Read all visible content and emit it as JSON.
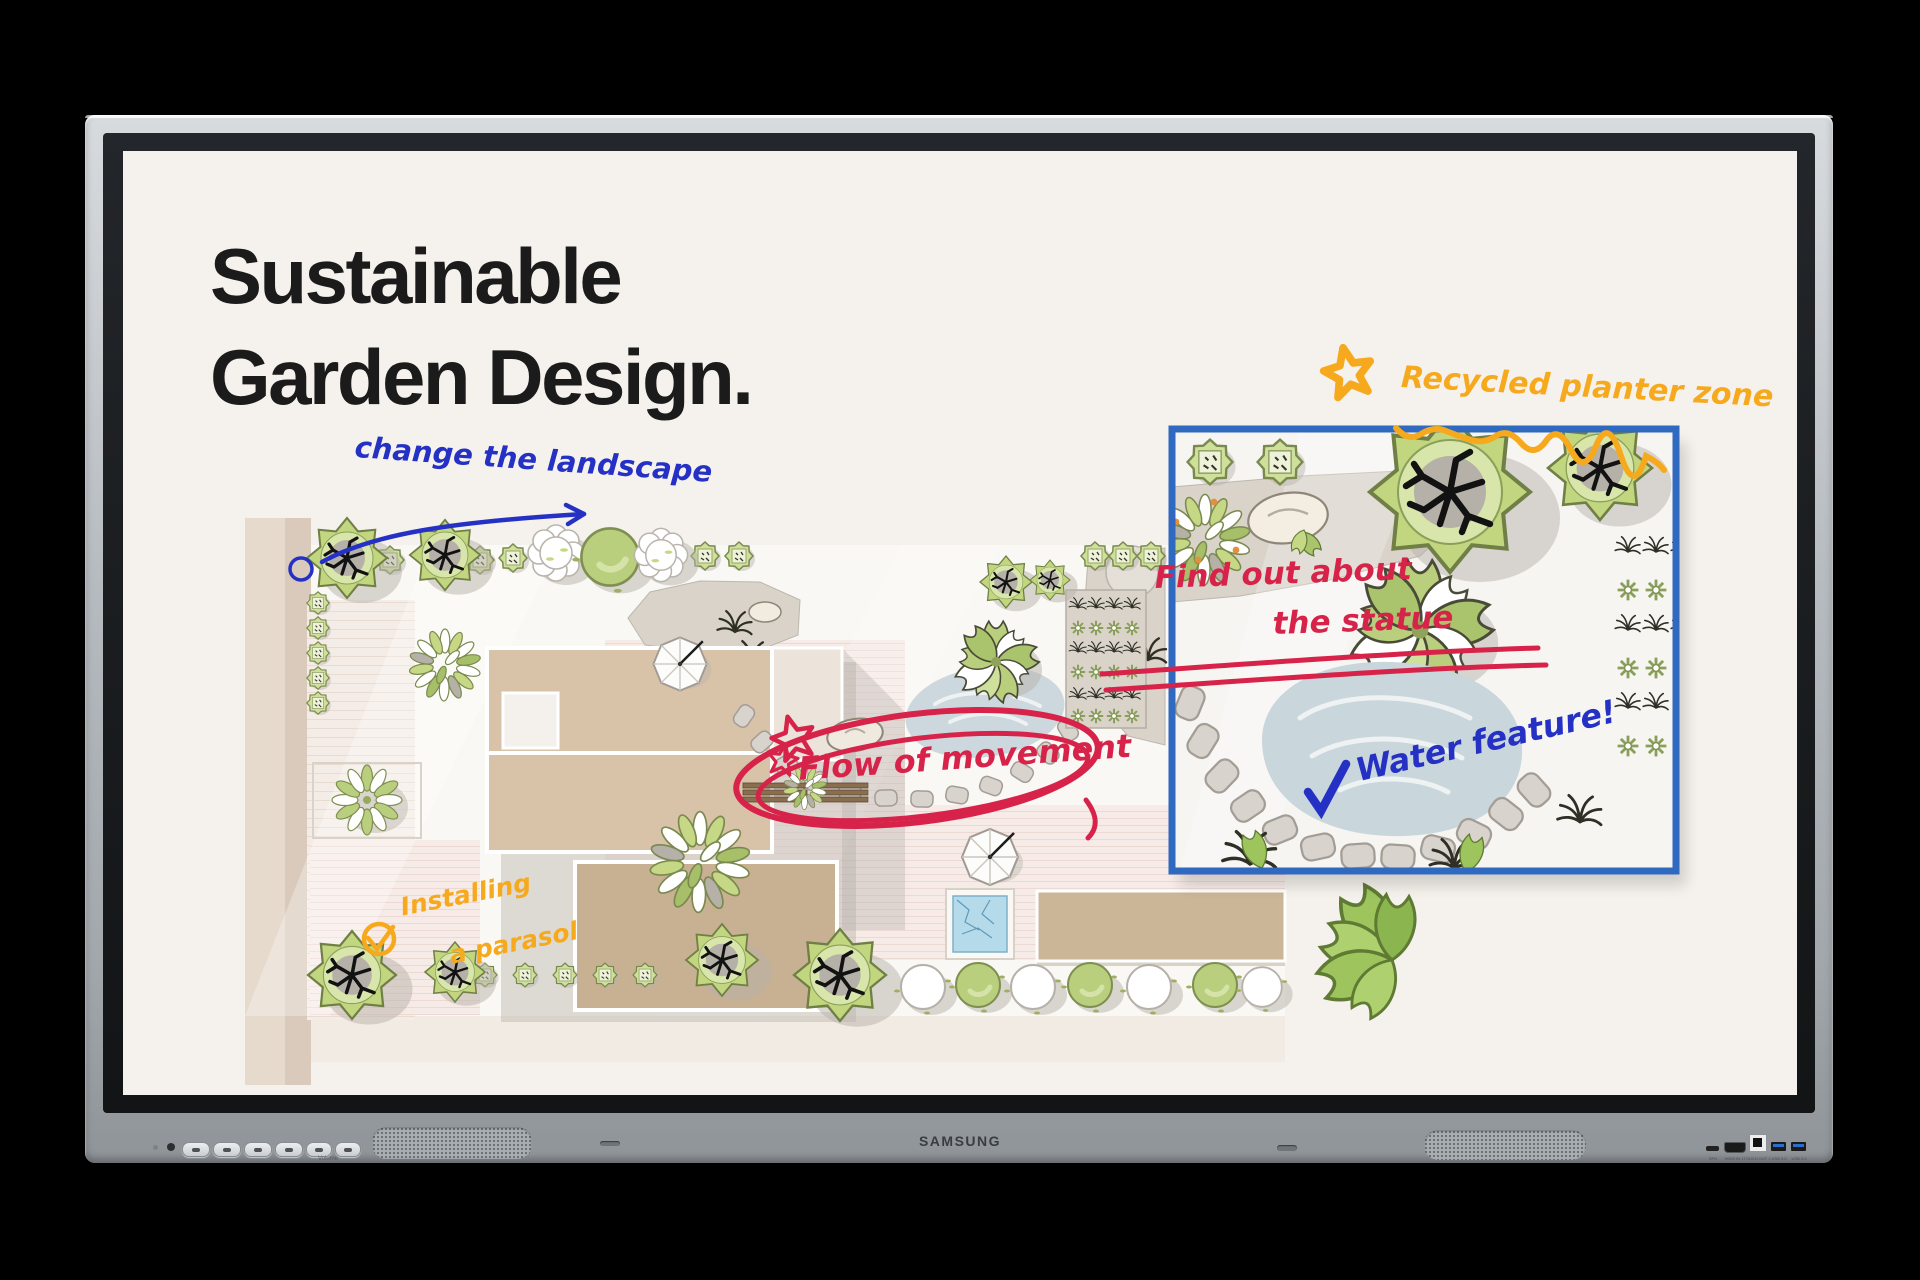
{
  "device": {
    "brand": "SAMSUNG",
    "bezel": {
      "button_icons": [
        "power-icon",
        "home-icon",
        "source-icon",
        "back-icon",
        "volume-down-icon",
        "volume-up-icon"
      ],
      "buttons_caption": "Volume",
      "ports": [
        {
          "label": "SPD"
        },
        {
          "label": "HDMI IN 1"
        },
        {
          "label": "TOUCH OUT 1"
        },
        {
          "label": "USB 3.0"
        },
        {
          "label": "USB 3.0"
        }
      ]
    }
  },
  "screen": {
    "background_color": "#f5f1ec",
    "title": {
      "line1": "Sustainable",
      "line2": "Garden Design.",
      "color": "#1b1b1b"
    },
    "annotations": {
      "landscape": {
        "text": "change the landscape",
        "color": "#2531c4"
      },
      "parasol": {
        "line1": "Installing",
        "line2": "a parasol",
        "color": "#f7a91e"
      },
      "flow": {
        "text": "Flow of movement",
        "color": "#d72349"
      },
      "statue": {
        "line1": "Find out about",
        "line2": "the statue",
        "color": "#d72349"
      },
      "planter": {
        "text": "Recycled planter zone",
        "color": "#f7a91e"
      },
      "water": {
        "text": "Water feature!",
        "color": "#2531c4"
      }
    },
    "inset": {
      "border_color": "#3069c0"
    }
  }
}
